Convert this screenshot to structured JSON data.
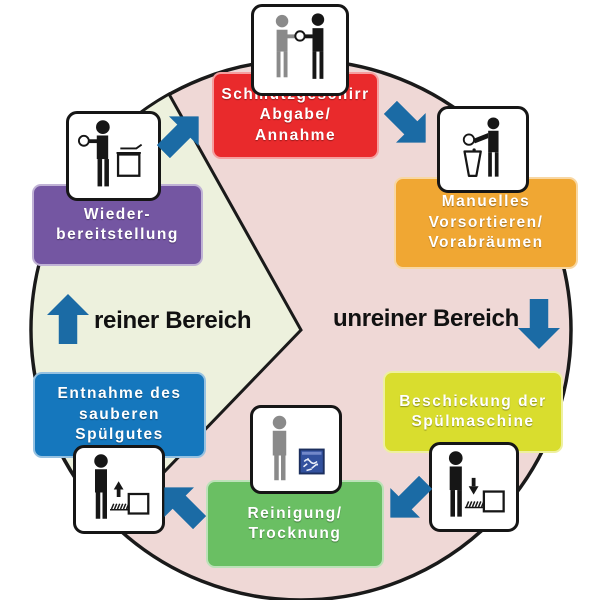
{
  "areas": {
    "clean": {
      "label": "reiner Bereich",
      "arrow_direction": "up"
    },
    "unclean": {
      "label": "unreiner Bereich",
      "arrow_direction": "down"
    }
  },
  "stages": [
    {
      "name": "schmutzgeschirr-abgabe",
      "lines": [
        "Schmutzgeschirr",
        "Abgabe/",
        "Annahme"
      ],
      "color": "#e92a2c",
      "icon": "dish-handover-icon"
    },
    {
      "name": "manuelles-vorsortieren",
      "lines": [
        "Manuelles",
        "Vorsortieren/",
        "Vorabräumen"
      ],
      "color": "#f0a733",
      "icon": "scrape-into-bin-icon"
    },
    {
      "name": "beschickung-spuelmaschine",
      "lines": [
        "Beschickung der",
        "Spülmaschine"
      ],
      "color": "#d9dd2e",
      "icon": "load-rack-icon"
    },
    {
      "name": "reinigung-trocknung",
      "lines": [
        "Reinigung/",
        "Trocknung"
      ],
      "color": "#6abf63",
      "icon": "dishwasher-running-icon"
    },
    {
      "name": "entnahme-spuelgut",
      "lines": [
        "Entnahme des",
        "sauberen",
        "Spülgutes"
      ],
      "color": "#1577bd",
      "icon": "unload-rack-icon"
    },
    {
      "name": "wiederbereitstellung",
      "lines": [
        "Wieder-",
        "bereitstellung"
      ],
      "color": "#7456a2",
      "icon": "restock-shelf-icon"
    }
  ],
  "colors": {
    "background": "#ffffff",
    "circle_fill": "#efd8d6",
    "wedge_fill": "#edf1dd",
    "outline": "#1a1a1a",
    "arrow": "#1b6ba5",
    "figure_black": "#161616",
    "figure_gray": "#8a8a8a",
    "machine_blue": "#32519e",
    "box_text": "#ffffff",
    "area_text": "#111111"
  }
}
